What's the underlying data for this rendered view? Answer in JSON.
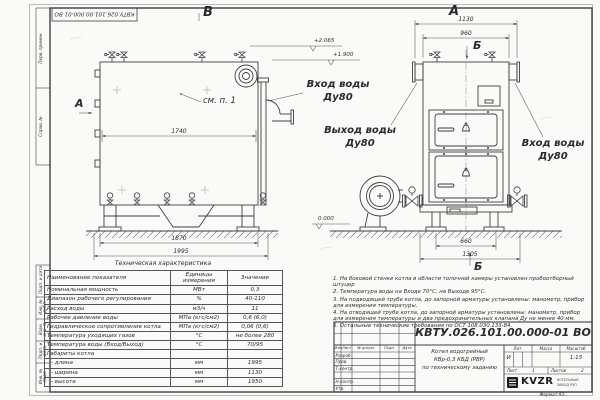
{
  "frame": {
    "top_designation": "КВТУ.026.101.00.000-01 ВО",
    "strip_labels": [
      "Перв. примен.",
      "Справ. №",
      "Подп. и дата",
      "Инв. № дубл.",
      "Взам. инв. №",
      "Подп. и дата",
      "Инв. № подл."
    ],
    "format_label": "Формат  А3"
  },
  "views": {
    "left_label": "В",
    "right_label": "А",
    "section_a": "А",
    "section_b_top": "Б",
    "section_b_bottom": "Б",
    "see_note": "см. п. 1",
    "inlet_top_l1": "Вход воды",
    "inlet_top_l2": "Ду80",
    "outlet_l1": "Выход воды",
    "outlet_l2": "Ду80",
    "inlet_right_l1": "Вход воды",
    "inlet_right_l2": "Ду80"
  },
  "dims": {
    "d1740": "1740",
    "d1870": "1870",
    "d1995": "1995",
    "d1130": "1130",
    "d960": "960",
    "d660": "660",
    "d1305": "1305"
  },
  "elevations": {
    "top": "+2.065",
    "mid": "+1.900",
    "zero": "0.000"
  },
  "tech_table": {
    "title": "Техническая характеристика",
    "col_name": "Наименование показателя",
    "col_unit": "Единицы измерения",
    "col_value": "Значение",
    "rows": [
      {
        "n": "Номинальная мощность",
        "u": "МВт",
        "v": "0,3"
      },
      {
        "n": "Диапазон рабочего регулирования",
        "u": "%",
        "v": "40-110"
      },
      {
        "n": "Расход воды",
        "u": "м3/ч",
        "v": "11"
      },
      {
        "n": "Рабочее давление воды",
        "u": "МПа (кгс/см2)",
        "v": "0,6 (6,0)"
      },
      {
        "n": "Гидравлическое сопротивление котла",
        "u": "МПа (кгс/см2)",
        "v": "0,06 (0,6)"
      },
      {
        "n": "Температура уходящих газов",
        "u": "°С",
        "v": "не более 280"
      },
      {
        "n": "Температура воды (Вход/Выход)",
        "u": "°С",
        "v": "70/95"
      },
      {
        "n": "Габариты котла",
        "u": "",
        "v": ""
      },
      {
        "n": "- длина",
        "u": "мм",
        "v": "1995"
      },
      {
        "n": "- ширина",
        "u": "мм",
        "v": "1130"
      },
      {
        "n": "- высота",
        "u": "мм",
        "v": "1950"
      }
    ]
  },
  "notes": {
    "items": [
      "1.  На боковой стенке котла в области топочной камеры установлен пробоотборный штуцер",
      "2.  Температура воды на Входе 70°С, на Выходе 95°С.",
      "3.  На подводящей трубе котла, до запорной арматуры установлены: манометр, прибор для измерения температуры.",
      "4.  На отводящей трубе котла, до запорной арматуры установлены: манометр, прибор для измерения температуры и два предохранительных клапана Ду не менее 40 мм.",
      "5.  Остальные технические требования по ОСТ 108.030.133-84."
    ]
  },
  "stamp": {
    "designation": "КВТУ.026.101.00.000-01 ВО",
    "title_l1": "Котел водогрейный",
    "title_l2": "КВр-0,3 КБД (РВР)",
    "title_l3": "по техническому заданию",
    "col_izm": "Изм.",
    "col_list": "Лист",
    "col_doc": "№ докум.",
    "col_sign": "Подп.",
    "col_date": "Дата",
    "row_razrab": "Разраб.",
    "row_prov": "Пров.",
    "row_tkontr": "Т.контр.",
    "row_nkontr": "Н.контр.",
    "row_utv": "Утв.",
    "lit_header": "Лит.",
    "mass_header": "Масса",
    "scale_header": "Масштаб",
    "lit_value": "И",
    "scale_value": "1:15",
    "sheet_label": "Лист",
    "sheet_value": "1",
    "sheets_label": "Листов",
    "sheets_value": "2",
    "logo_text": "KVZR",
    "logo_sub_l1": "КОТЕЛЬНЫЙ",
    "logo_sub_l2": "ЗАВОД РЭП"
  }
}
